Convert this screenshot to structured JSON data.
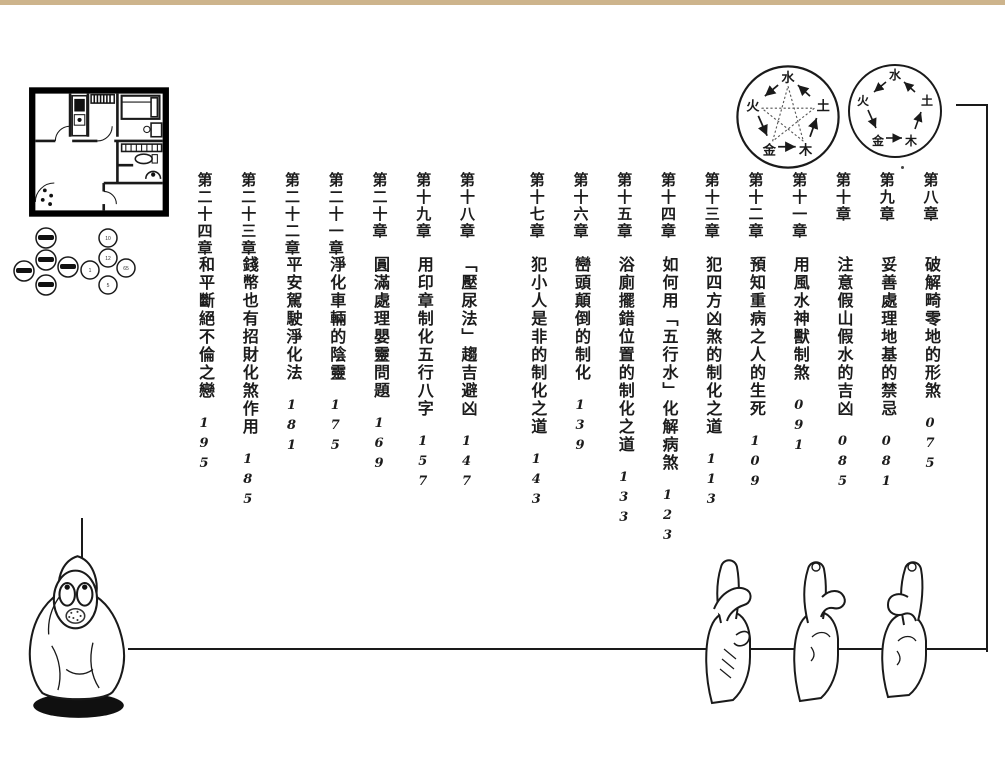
{
  "toc": {
    "chapters": [
      {
        "num": "第八章",
        "title": "破解畸零地的形煞",
        "page": "075"
      },
      {
        "num": "第九章",
        "title": "妥善處理地基的禁忌",
        "page": "081"
      },
      {
        "num": "第十章",
        "title": "注意假山假水的吉凶",
        "page": "085"
      },
      {
        "num": "第十一章",
        "title": "用風水神獸制煞",
        "page": "091"
      },
      {
        "num": "第十二章",
        "title": "預知重病之人的生死",
        "page": "109"
      },
      {
        "num": "第十三章",
        "title": "犯四方凶煞的制化之道",
        "page": "113"
      },
      {
        "num": "第十四章",
        "title": "如何用「五行水」化解病煞",
        "page": "123"
      },
      {
        "num": "第十五章",
        "title": "浴廁擺錯位置的制化之道",
        "page": "133"
      },
      {
        "num": "第十六章",
        "title": "巒頭顛倒的制化",
        "page": "139"
      },
      {
        "num": "第十七章",
        "title": "犯小人是非的制化之道",
        "page": "143"
      },
      {
        "num": "第十八章",
        "title": "「壓尿法」趨吉避凶",
        "page": "147"
      },
      {
        "num": "第十九章",
        "title": "用印章制化五行八字",
        "page": "157"
      },
      {
        "num": "第二十章",
        "title": "圓滿處理嬰靈問題",
        "page": "169"
      },
      {
        "num": "第二十一章",
        "title": "淨化車輛的陰靈",
        "page": "175"
      },
      {
        "num": "第二十二章",
        "title": "平安駕駛淨化法",
        "page": "181"
      },
      {
        "num": "第二十三章",
        "title": "錢幣也有招財化煞作用",
        "page": "185"
      },
      {
        "num": "第二十四章",
        "title": "和平斷絕不倫之戀",
        "page": "195"
      }
    ]
  },
  "five_element_diagrams": {
    "elements": {
      "water": "水",
      "earth": "土",
      "wood": "木",
      "metal": "金",
      "fire": "火"
    }
  },
  "coin_diagram": {
    "right_cluster_labels": [
      "10",
      "12",
      "1",
      "65",
      "5"
    ]
  }
}
